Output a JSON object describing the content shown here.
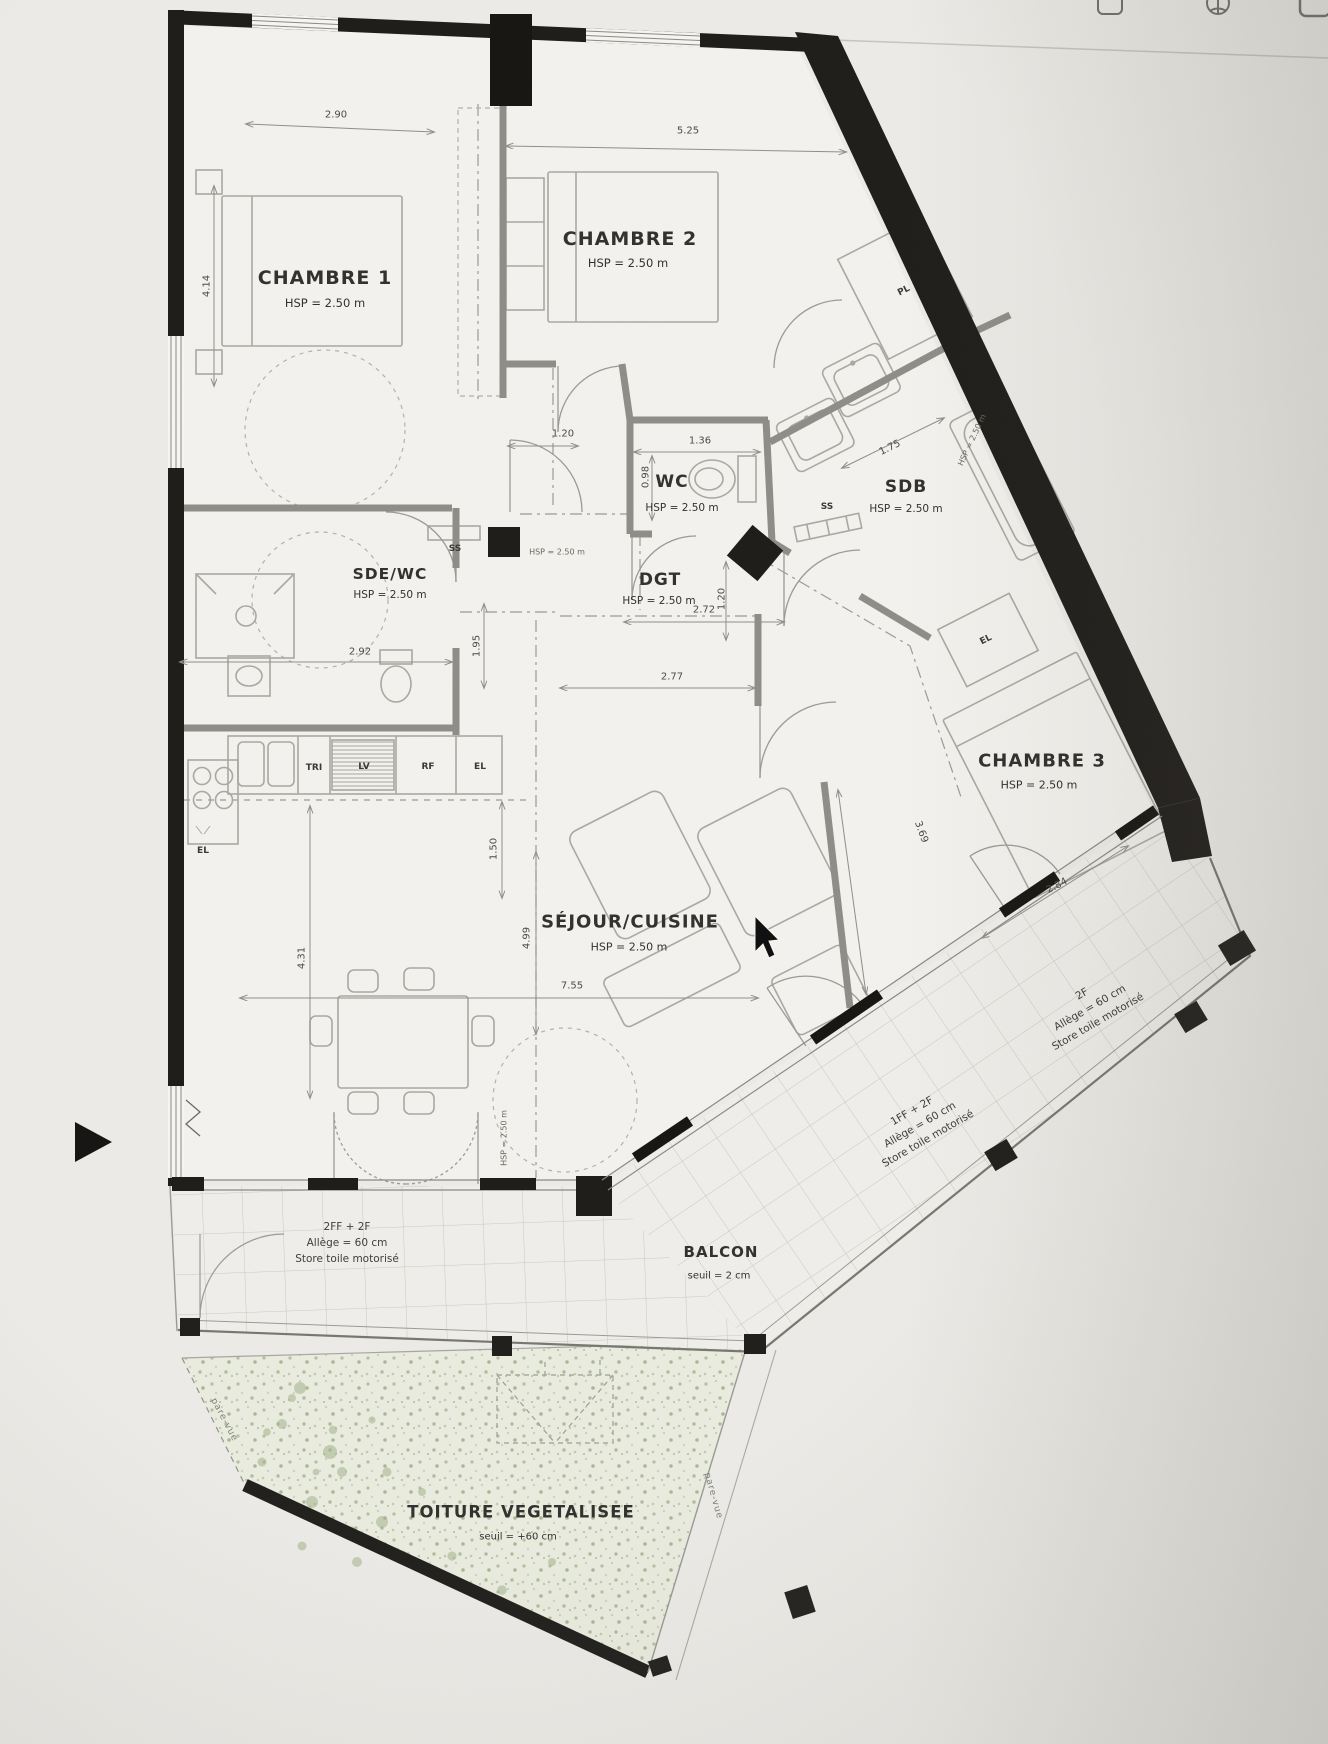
{
  "window": {
    "toolbar_icons": [
      "bookmark-square-icon",
      "globe-icon",
      "app-window-icon"
    ]
  },
  "plan": {
    "rooms": {
      "chambre1": {
        "name": "CHAMBRE 1",
        "hsp": "HSP = 2.50 m"
      },
      "chambre2": {
        "name": "CHAMBRE 2",
        "hsp": "HSP = 2.50 m"
      },
      "chambre3": {
        "name": "CHAMBRE 3",
        "hsp": "HSP = 2.50 m"
      },
      "wc": {
        "name": "WC",
        "hsp": "HSP = 2.50 m"
      },
      "sdb": {
        "name": "SDB",
        "hsp": "HSP = 2.50 m"
      },
      "sde_wc": {
        "name": "SDE/WC",
        "hsp": "HSP = 2.50 m"
      },
      "dgt": {
        "name": "DGT",
        "hsp": "HSP = 2.50 m"
      },
      "sejour": {
        "name": "SÉJOUR/CUISINE",
        "hsp": "HSP = 2.50 m"
      },
      "balcon": {
        "name": "BALCON",
        "note": "seuil = 2 cm"
      },
      "toiture": {
        "name": "TOITURE VEGETALISEE",
        "note": "seuil = +60 cm"
      }
    },
    "dimensions": {
      "chambre1_width": "2.90",
      "chambre2_width": "5.25",
      "chambre1_height": "4.14",
      "chambre1_door": "1.20",
      "wc_width": "1.36",
      "wc_depth": "0.98",
      "sdb_width": "1.75",
      "sde_width": "2.92",
      "sde_door": "1.95",
      "dgt_width": "2.72",
      "dgt_depth": "1.20",
      "sejour_opening": "2.77",
      "sejour_width": "7.55",
      "sejour_depth": "4.99",
      "kitchen_depth": "1.50",
      "sejour_left": "4.31",
      "chambre3_side": "3.69",
      "chambre3_width": "2.84"
    },
    "equipment": {
      "tri": "TRI",
      "lv": "LV",
      "rf": "RF",
      "el": "EL",
      "el_kitchen": "EL",
      "el_ch3": "EL",
      "pl": "PL",
      "ss_sde": "SS",
      "ss_sdb": "SS"
    },
    "notes": {
      "hsp_small_1": "HSP = 2.50 m",
      "hsp_small_2": "HSP = 2.50 m",
      "hsp_small_3": "HSP = 2.50 m",
      "window_south": {
        "l1": "2FF + 2F",
        "l2": "Allège = 60 cm",
        "l3": "Store toile motorisé"
      },
      "window_balcony_mid": {
        "l1": "1FF + 2F",
        "l2": "Allège = 60 cm",
        "l3": "Store toile motorisé"
      },
      "window_balcony_high": {
        "l1": "2F",
        "l2": "Allège = 60 cm",
        "l3": "Store toile motorisé"
      },
      "pare_vue_left": "pare-vue",
      "pare_vue_right": "pare-vue"
    }
  }
}
